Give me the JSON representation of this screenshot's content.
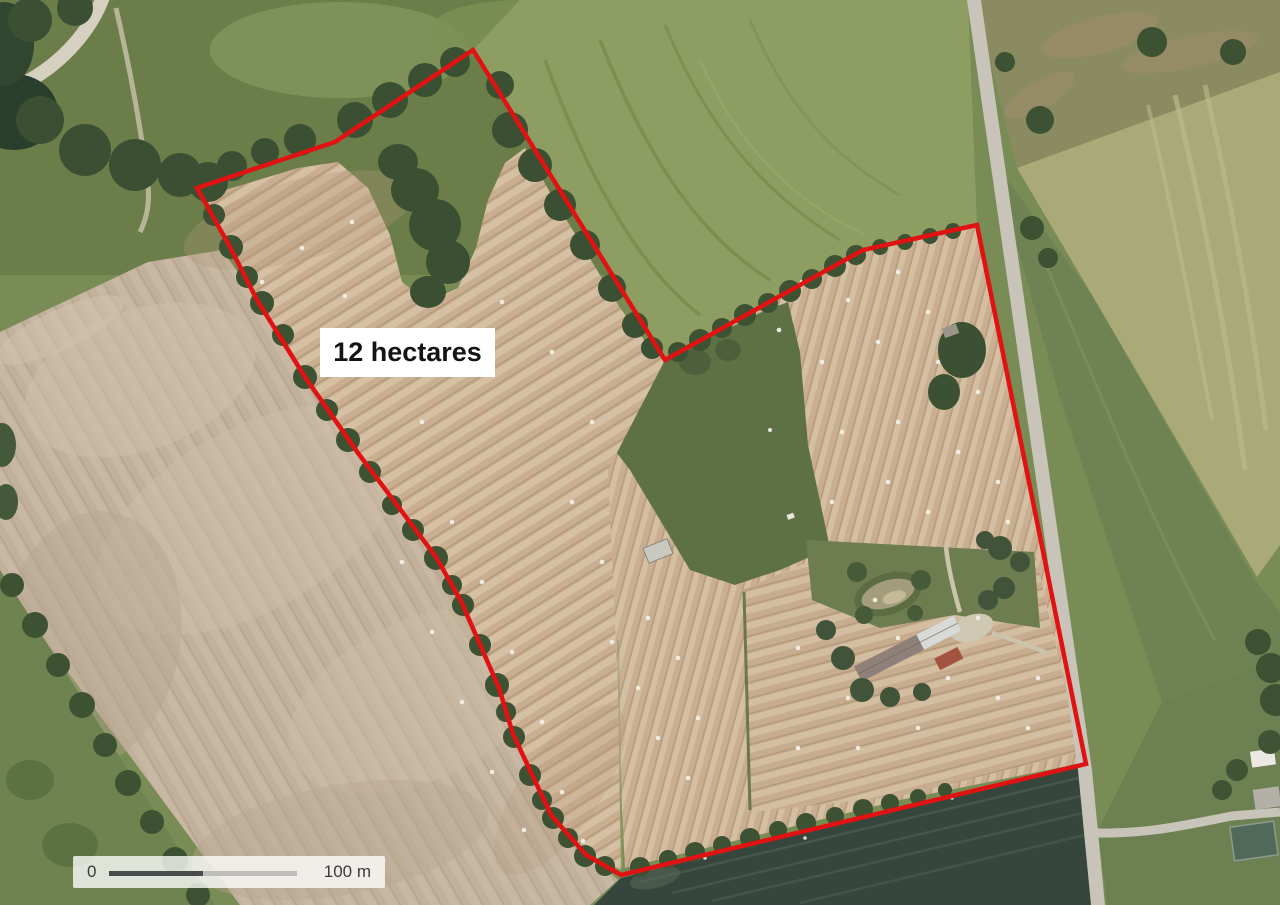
{
  "map": {
    "annotation": {
      "area_label": "12 hectares",
      "boundary_color": "#e01212",
      "boundary_stroke_width": "4.5",
      "boundary_points": "473,50 335,142 197,188 230,247 257,300 305,377 358,453 436,557 461,601 499,688 513,734 551,815 586,855 621,875 1086,764 977,225 863,250 665,360"
    },
    "scale_bar": {
      "zero_label": "0",
      "distance_label": "100 m",
      "bar_dark_color": "#4b4b4b",
      "bar_light_color": "#bdbdb9",
      "panel_background": "rgba(255,255,255,0.78)"
    },
    "terrain_colors": {
      "grass_green": "#7a8c55",
      "plowed_field_beige": "#c1b19c",
      "hay_field_tan": "#c9ae91",
      "pasture_green": "#5e7145",
      "woodland_green": "#3b5032",
      "dark_crop_teal": "#37463d",
      "road_gray": "#c8c4b9",
      "yellow_crop_field": "#a9aa77"
    }
  }
}
